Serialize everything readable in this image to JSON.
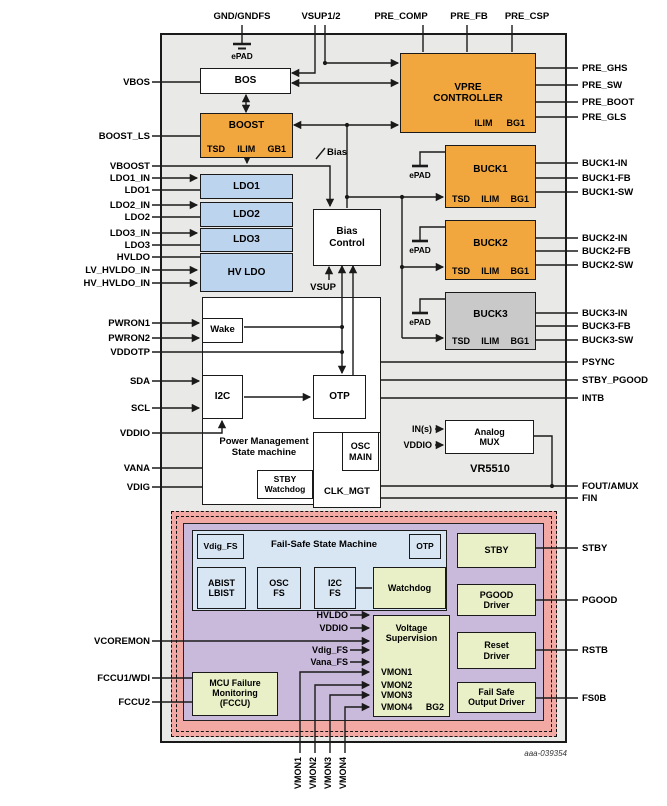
{
  "figure_id": "aaa-039354",
  "chip_name": "VR5510",
  "pins": {
    "top": [
      "GND/GNDFS",
      "VSUP1/2",
      "PRE_COMP",
      "PRE_FB",
      "PRE_CSP"
    ],
    "left": [
      "VBOS",
      "BOOST_LS",
      "VBOOST",
      "LDO1_IN",
      "LDO1",
      "LDO2_IN",
      "LDO2",
      "LDO3_IN",
      "LDO3",
      "HVLDO",
      "LV_HVLDO_IN",
      "HV_HVLDO_IN",
      "PWRON1",
      "PWRON2",
      "VDDOTP",
      "SDA",
      "SCL",
      "VDDIO",
      "VANA",
      "VDIG",
      "VCOREMON",
      "FCCU1/WDI",
      "FCCU2"
    ],
    "right": [
      "PRE_GHS",
      "PRE_SW",
      "PRE_BOOT",
      "PRE_GLS",
      "BUCK1-IN",
      "BUCK1-FB",
      "BUCK1-SW",
      "BUCK2-IN",
      "BUCK2-FB",
      "BUCK2-SW",
      "BUCK3-IN",
      "BUCK3-FB",
      "BUCK3-SW",
      "PSYNC",
      "STBY_PGOOD",
      "INTB",
      "FOUT/AMUX",
      "FIN",
      "STBY",
      "PGOOD",
      "RSTB",
      "FS0B"
    ],
    "bottom": [
      "VMON1",
      "VMON2",
      "VMON3",
      "VMON4"
    ]
  },
  "blocks": {
    "bos": "BOS",
    "boost": {
      "title": "BOOST",
      "cells": [
        "TSD",
        "ILIM",
        "GB1"
      ]
    },
    "vpre": {
      "title": "VPRE\nCONTROLLER",
      "cells": [
        "ILIM",
        "BG1"
      ]
    },
    "ldo1": "LDO1",
    "ldo2": "LDO2",
    "ldo3": "LDO3",
    "hvldo": "HV LDO",
    "bias_control": "Bias\nControl",
    "buck1": {
      "title": "BUCK1",
      "cells": [
        "TSD",
        "ILIM",
        "BG1"
      ]
    },
    "buck2": {
      "title": "BUCK2",
      "cells": [
        "TSD",
        "ILIM",
        "BG1"
      ]
    },
    "buck3": {
      "title": "BUCK3",
      "cells": [
        "TSD",
        "ILIM",
        "BG1"
      ]
    },
    "wake": "Wake",
    "i2c": "I2C",
    "otp": "OTP",
    "pm_state_machine": "Power Management\nState machine",
    "osc_main": "OSC\nMAIN",
    "clk_mgt": "CLK_MGT",
    "stby_watchdog": "STBY\nWatchdog",
    "analog_mux": "Analog\nMUX"
  },
  "failsafe": {
    "state_machine": "Fail-Safe State Machine",
    "vdig_fs": "Vdig_FS",
    "otp": "OTP",
    "abist_lbist": "ABIST\nLBIST",
    "osc_fs": "OSC\nFS",
    "i2c_fs": "I2C\nFS",
    "watchdog": "Watchdog",
    "voltage_supervision": "Voltage\nSupervision",
    "vs_inputs": [
      "HVLDO",
      "VDDIO",
      "Vdig_FS",
      "Vana_FS"
    ],
    "vmon_list": [
      "VMON1",
      "VMON2",
      "VMON3",
      "VMON4"
    ],
    "bg2": "BG2",
    "mcu_failure": "MCU Failure\nMonitoring\n(FCCU)",
    "stby": "STBY",
    "pgood_driver": "PGOOD\nDriver",
    "reset_driver": "Reset\nDriver",
    "fs_output_driver": "Fail Safe\nOutput Driver"
  },
  "net_labels": {
    "bias": "Bias",
    "vsup": "VSUP",
    "epad": "ePAD",
    "ins": "IN(s)",
    "vddio_mux": "VDDIO"
  },
  "colors": {
    "orange": "#F2A73E",
    "ldo_blue": "#BDD4EE",
    "failsafe_blue": "#D8E5F3",
    "green": "#E9EFC6",
    "purple": "#C9BADC",
    "pink": "#F2A8A3",
    "buck3_gray": "#C9C9C9",
    "chip_bg": "#E9E9E7",
    "line": "#1A1A1A"
  }
}
